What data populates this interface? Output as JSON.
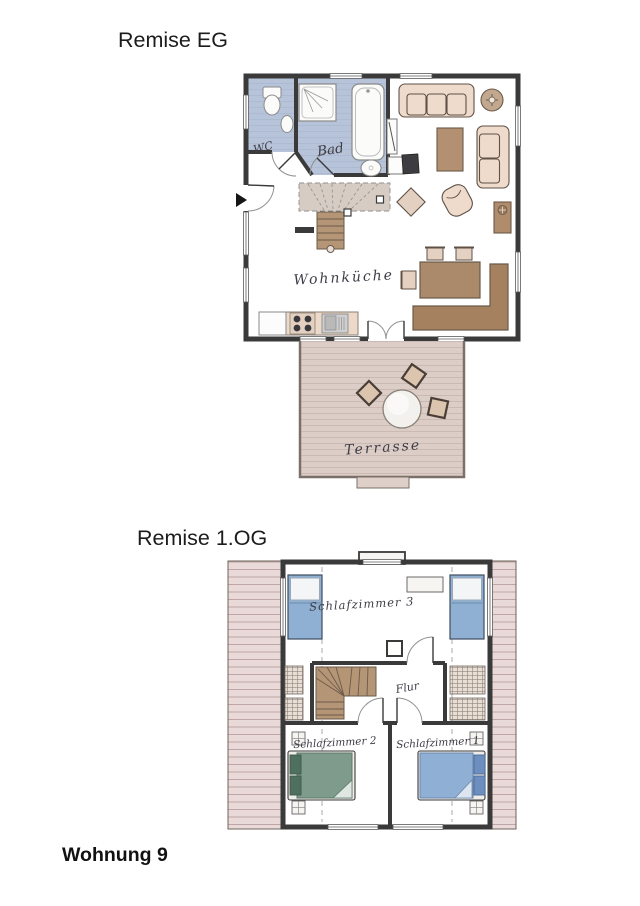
{
  "titles": {
    "floor1": "Remise EG",
    "floor2": "Remise 1.OG",
    "apartment": "Wohnung 9"
  },
  "eg": {
    "wc": "WC",
    "bad": "Bad",
    "wohnkueche": "Wohnküche",
    "terrasse": "Terrasse"
  },
  "og": {
    "schlafzimmer3": "Schlafzimmer 3",
    "flur": "Flur",
    "schlafzimmer2": "Schlafzimmer 2",
    "schlafzimmer1": "Schlafzimmer 1"
  },
  "colors": {
    "wall": "#3a3a3a",
    "floor": "#d9d0ca",
    "bath_floor": "#b6c3d9",
    "roof": "#ead9d9",
    "terrace_floor": "#dccdc7",
    "wood_stairs": "#b49576",
    "furniture_beige": "#eedbcb",
    "furniture_brown": "#ab8a6c",
    "bed_blue": "#8fb0d2",
    "bed_green": "#7e9b8b",
    "tv_dark": "#3d3d41"
  }
}
